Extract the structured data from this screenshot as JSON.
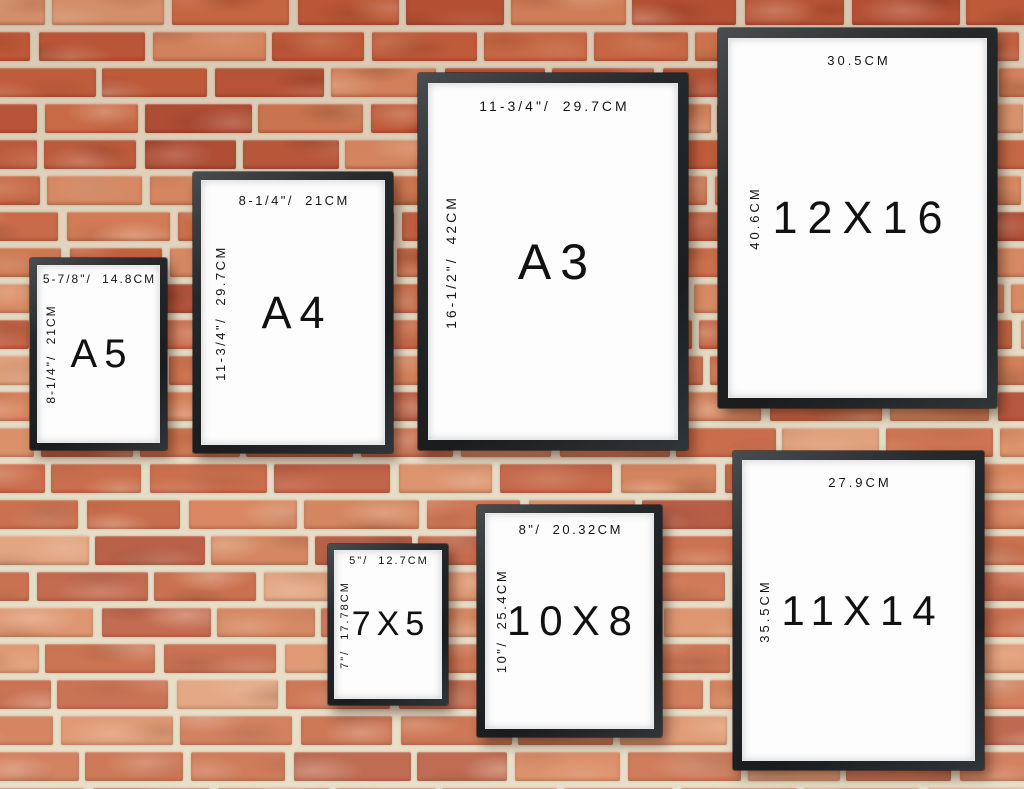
{
  "wall": {
    "mortar_color": "#e4d9c3",
    "brick_palette": [
      "#c4603d",
      "#cd6d47",
      "#ba5539",
      "#d47a52",
      "#bf5a3b",
      "#c96845",
      "#b04c33",
      "#d8875f",
      "#ce7850",
      "#c25d3a",
      "#dd9a74",
      "#d98a62"
    ]
  },
  "frames": [
    {
      "name": "A5",
      "size_label": "A5",
      "top_label": "5-7/8\"/ 14.8CM",
      "side_label": "8-1/4\"/ 21CM"
    },
    {
      "name": "A4",
      "size_label": "A4",
      "top_label": "8-1/4\"/ 21CM",
      "side_label": "11-3/4\"/ 29.7CM"
    },
    {
      "name": "A3",
      "size_label": "A3",
      "top_label": "11-3/4\"/ 29.7CM",
      "side_label": "16-1/2\"/ 42CM"
    },
    {
      "name": "12X16",
      "size_label": "12X16",
      "top_label": "30.5CM",
      "side_label": "40.6CM"
    },
    {
      "name": "7X5",
      "size_label": "7X5",
      "top_label": "5\"/ 12.7CM",
      "side_label": "7\"/ 17.78CM"
    },
    {
      "name": "10X8",
      "size_label": "10X8",
      "top_label": "8\"/ 20.32CM",
      "side_label": "10\"/ 25.4CM"
    },
    {
      "name": "11X14",
      "size_label": "11X14",
      "top_label": "27.9CM",
      "side_label": "35.5CM"
    }
  ]
}
